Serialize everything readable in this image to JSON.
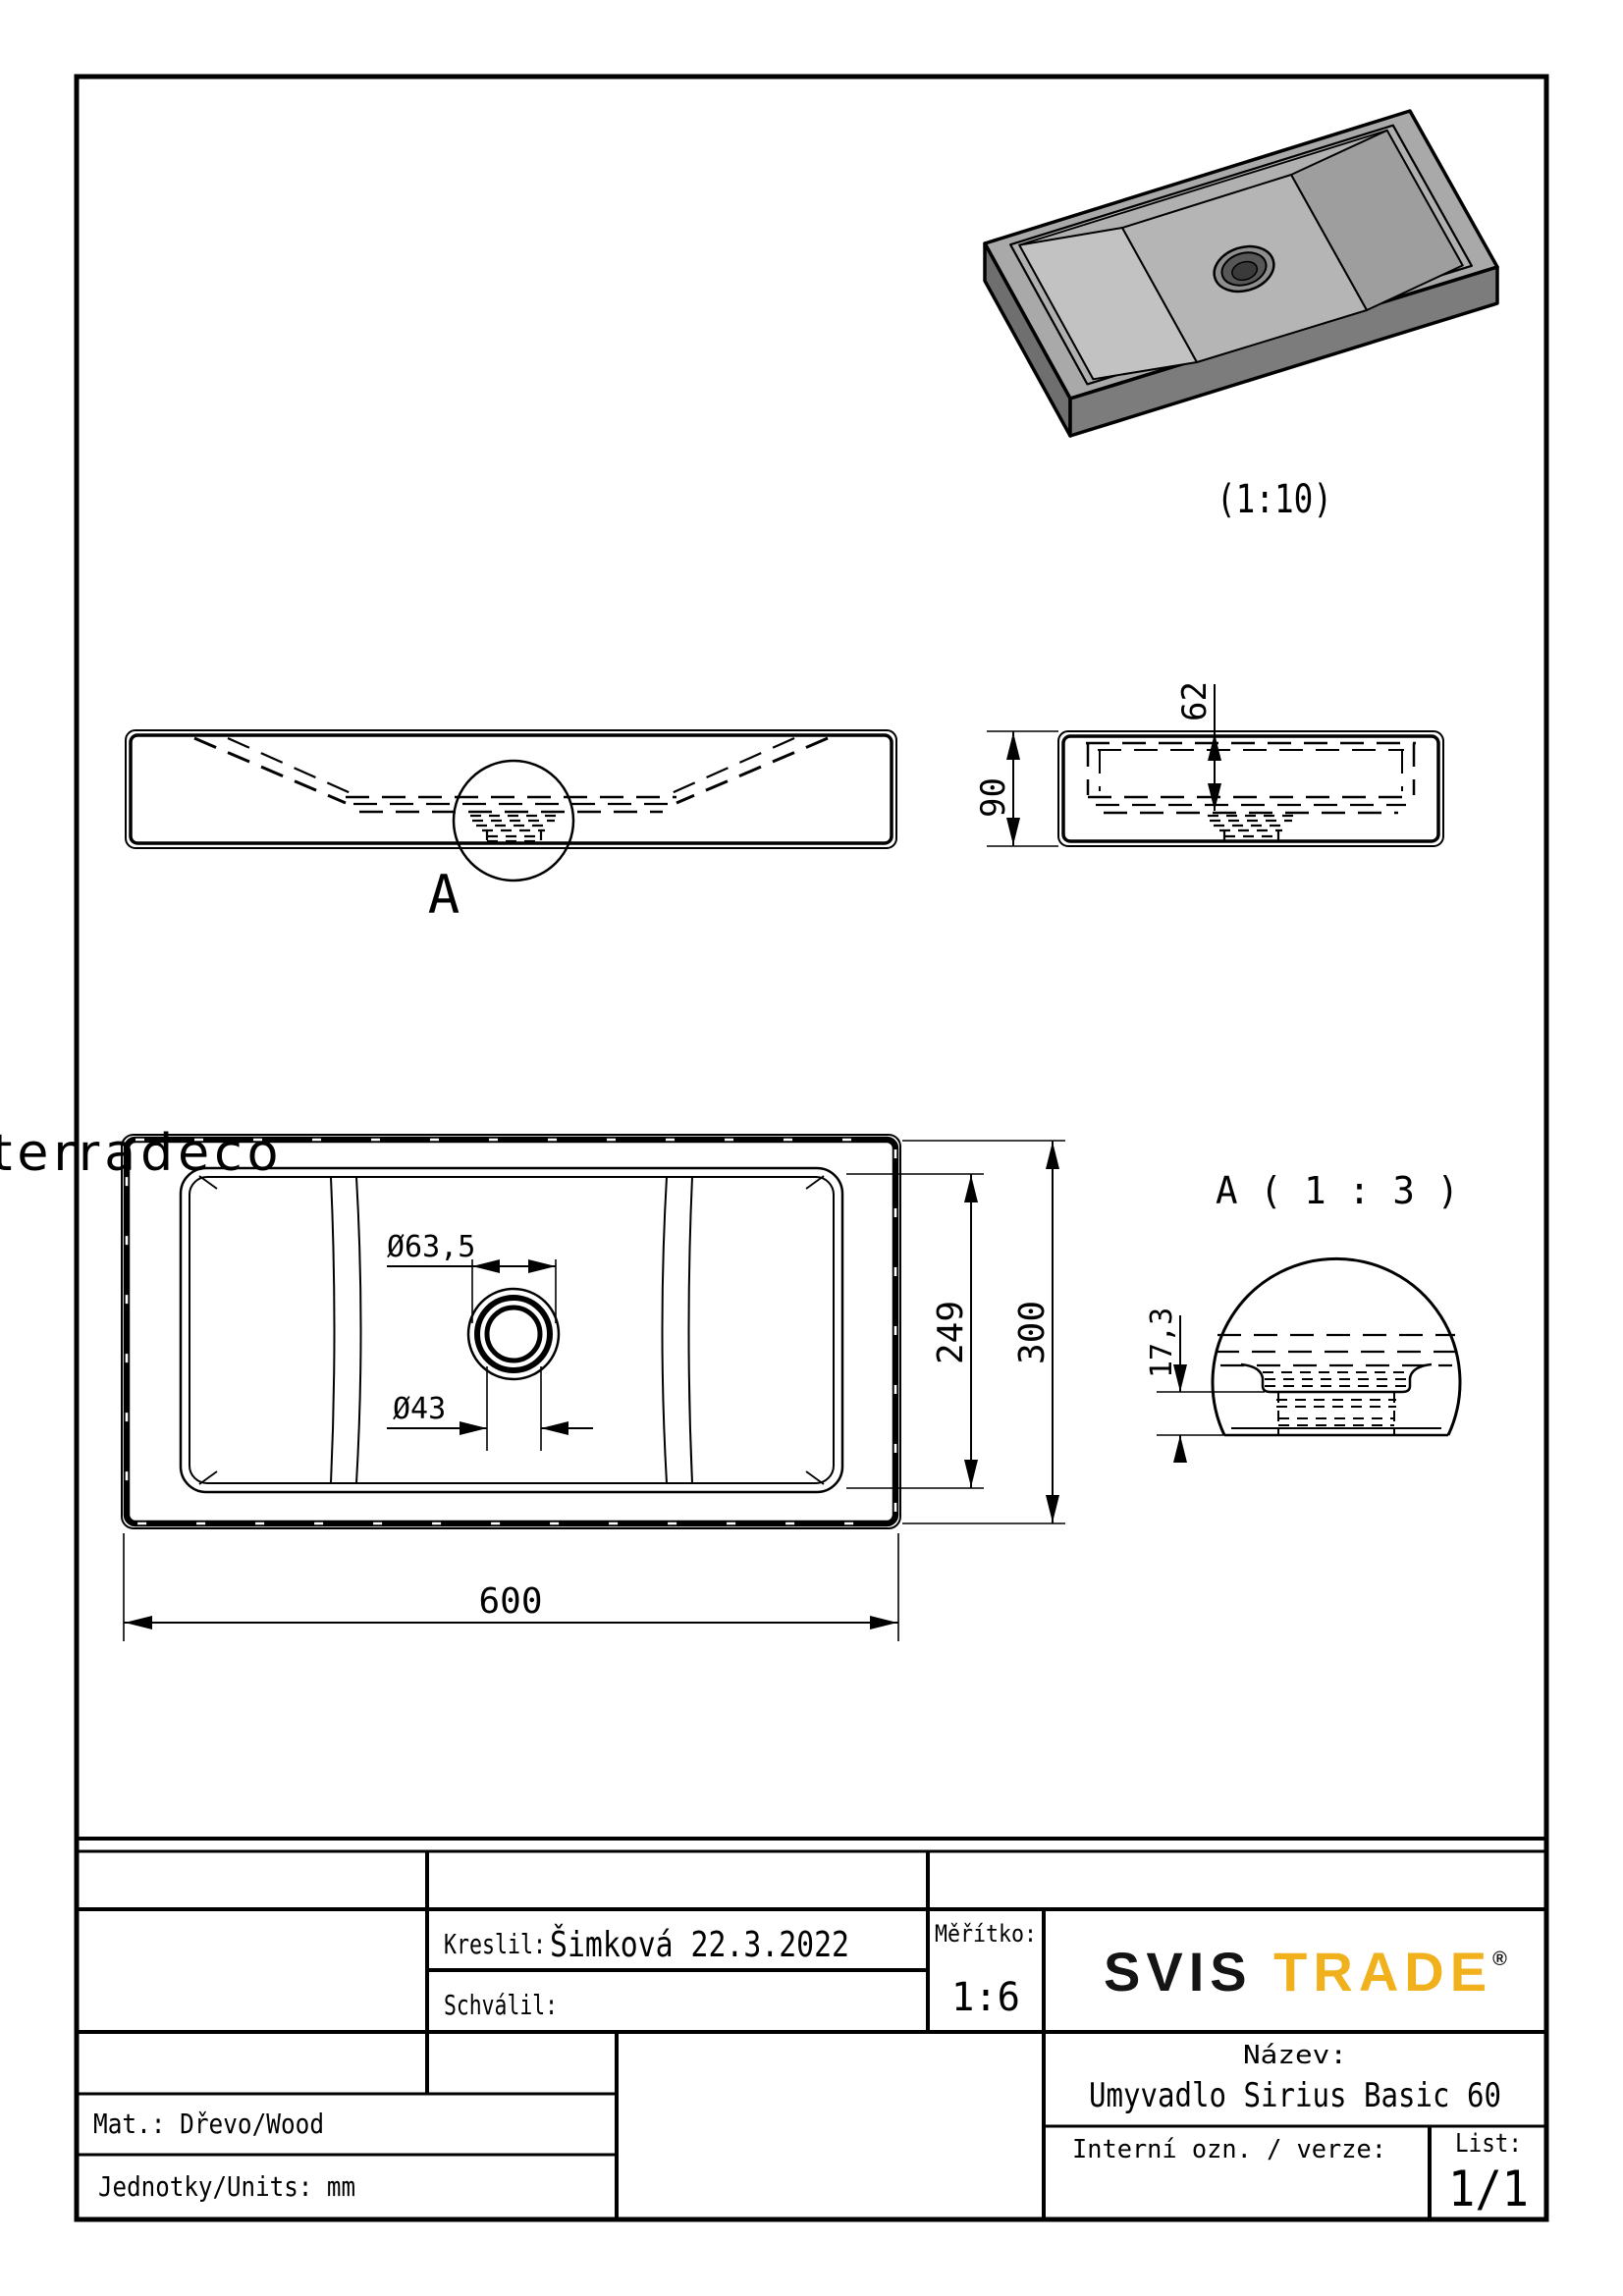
{
  "watermark": "terradeco",
  "view_3d": {
    "scale_label": "(1:10)"
  },
  "view_front": {
    "detail_marker": "A"
  },
  "view_side": {
    "dim_height": "90",
    "dim_basin_depth": "62"
  },
  "view_plan": {
    "dim_width": "600",
    "dim_depth": "300",
    "dim_basin_depth": "249",
    "dim_drain_outer": "Ø63,5",
    "dim_drain_inner": "Ø43"
  },
  "view_detail": {
    "title": "A ( 1 : 3 )",
    "dim_thickness": "17,3"
  },
  "title_block": {
    "kreslil_label": "Kreslil:",
    "kreslil_value": "Šimková 22.3.2022",
    "schvalil_label": "Schválil:",
    "meritko_label": "Měřítko:",
    "meritko_value": "1:6",
    "nazev_label": "Název:",
    "nazev_value": "Umyvadlo Sirius Basic 60",
    "interni_label": "Interní ozn. / verze:",
    "list_label": "List:",
    "list_value": "1/1",
    "mat_value": "Mat.: Dřevo/Wood",
    "jednotky_value": "Jednotky/Units: mm",
    "logo": {
      "part1": "SVIS ",
      "part2": "TRADE",
      "reg": "®",
      "accent_color": "#F0B11C"
    }
  },
  "colors": {
    "line": "#000000",
    "watermark_pink": "#E28484",
    "logo_yellow": "#F0B11C"
  }
}
